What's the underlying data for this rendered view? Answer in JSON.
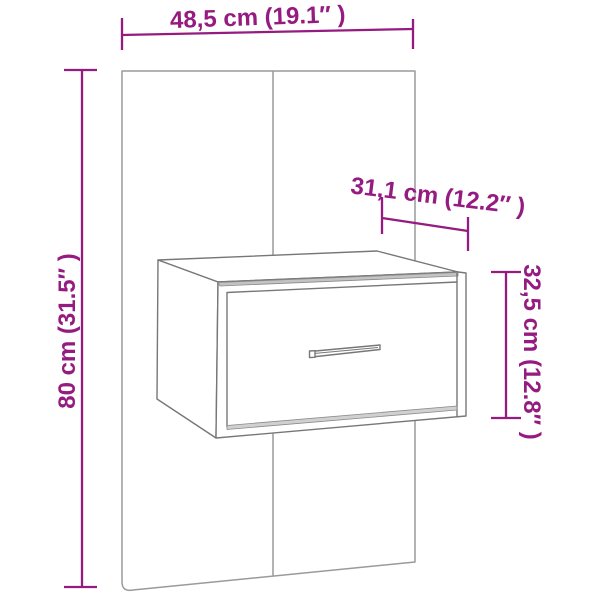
{
  "diagram": {
    "type": "furniture-dimension-diagram",
    "colors": {
      "background": "#ffffff",
      "dimension_accent": "#951b81",
      "panel_outline": "#9a9a9a",
      "cabinet_outline": "#777777"
    },
    "dimensions": {
      "width_label": "48,5 cm (19.1″ )",
      "total_height_label": "80 cm (31.5″ )",
      "depth_label": "31,1 cm (12.2″ )",
      "cabinet_height_label": "32,5 cm (12.8″ )"
    }
  }
}
